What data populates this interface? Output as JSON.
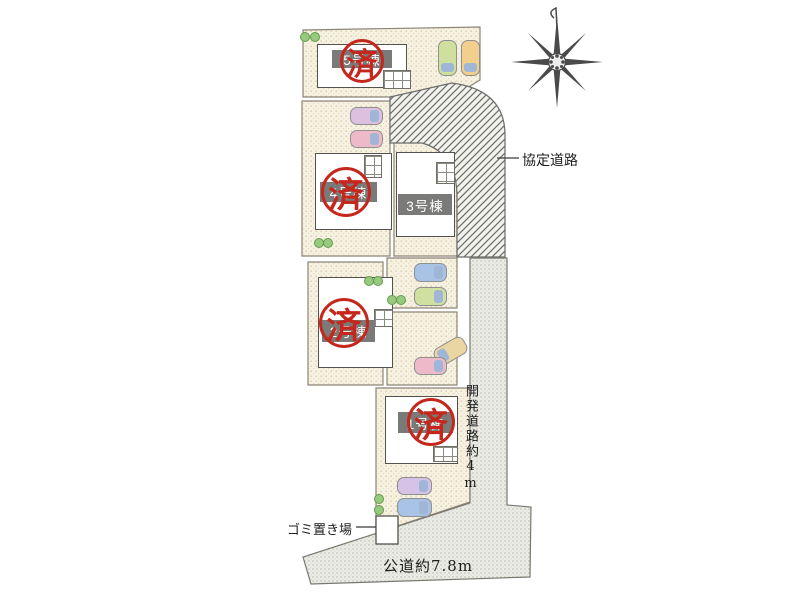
{
  "plan": {
    "title": "housing site plan",
    "buildings": {
      "b5": {
        "label": "5号棟",
        "stamp": "済",
        "sold": true
      },
      "b4": {
        "label": "4号棟",
        "stamp": "済",
        "sold": true
      },
      "b3": {
        "label": "3号棟",
        "sold": false
      },
      "b2": {
        "label": "2号棟",
        "stamp": "済",
        "sold": true
      },
      "b1": {
        "label": "1号棟",
        "stamp": "済",
        "sold": true
      }
    },
    "annotations": {
      "agreement_road": "協定道路",
      "development_road": "開発道路約4m",
      "public_road": "公道約7.8m",
      "garbage": "ゴミ置き場"
    },
    "compass": {
      "type": "eight-point-star",
      "north": "up"
    },
    "colors": {
      "lot_fill": "#f6f1e0",
      "road_fill": "#ebece6",
      "hatch_line": "#6f6f6f",
      "stamp_red": "#c5271c",
      "label_band": "#7a7a78",
      "building_outline": "#55524d"
    },
    "cars": [
      {
        "location": "lot-5 parking",
        "color": "green"
      },
      {
        "location": "lot-5 parking",
        "color": "orange"
      },
      {
        "location": "lot-4 parking",
        "color": "lavender"
      },
      {
        "location": "lot-4 parking",
        "color": "pink"
      },
      {
        "location": "lot-3 parking",
        "color": "blue"
      },
      {
        "location": "lot-3 parking",
        "color": "green"
      },
      {
        "location": "lot-2 parking",
        "color": "tan"
      },
      {
        "location": "lot-2 parking",
        "color": "pink"
      },
      {
        "location": "lot-1 parking",
        "color": "lavender"
      },
      {
        "location": "lot-1 parking",
        "color": "blue"
      }
    ]
  }
}
